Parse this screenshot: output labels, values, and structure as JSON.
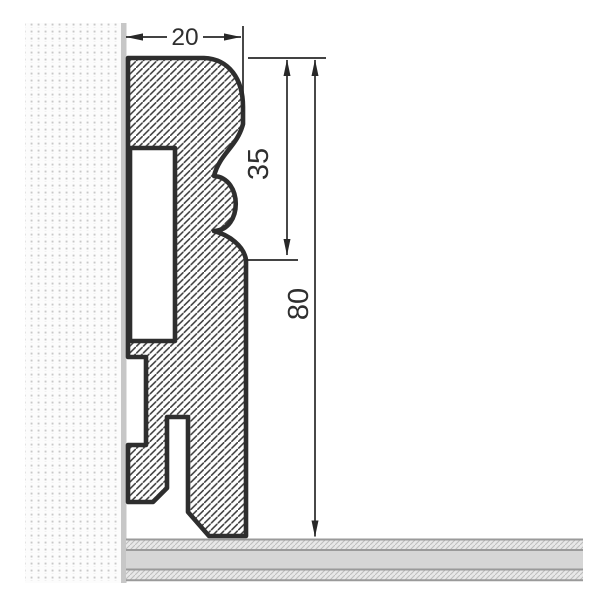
{
  "drawing": {
    "dimensions": {
      "width_mm": "20",
      "upper_section_height_mm": "35",
      "total_height_mm": "80"
    },
    "colors": {
      "outline": "#2e2e2e",
      "dimension_lines": "#282828",
      "profile_hatch": "#3a3a3a",
      "wall_dot": "#c8c8c8",
      "wall_finish_strip": "#c7c7c7",
      "floor_solid": "#d6d6d6",
      "floor_hatch_band": "#e8e8e8",
      "floor_border": "#9a9a9a"
    }
  }
}
